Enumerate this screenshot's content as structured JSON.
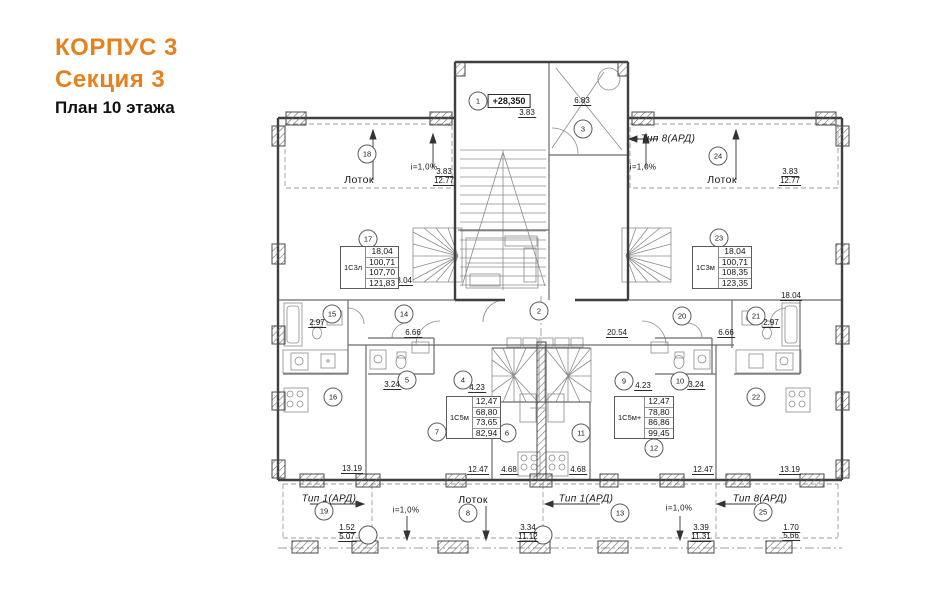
{
  "title": {
    "building": "КОРПУС 3",
    "section": "Секция 3",
    "floor": "План 10 этажа"
  },
  "colors": {
    "accent": "#e5821f",
    "wall": "#3f3f3f",
    "thin_line": "#8c8c8c"
  },
  "plan": {
    "elevation": {
      "t": "+28,350",
      "x": 509,
      "y": 101
    },
    "rooms": [
      {
        "n": "1",
        "x": 478,
        "y": 101
      },
      {
        "n": "2",
        "x": 539,
        "y": 311
      },
      {
        "n": "3",
        "x": 583,
        "y": 129
      },
      {
        "n": "4",
        "x": 463,
        "y": 380
      },
      {
        "n": "5",
        "x": 407,
        "y": 380
      },
      {
        "n": "6",
        "x": 507,
        "y": 433
      },
      {
        "n": "7",
        "x": 437,
        "y": 432
      },
      {
        "n": "8",
        "x": 468,
        "y": 513
      },
      {
        "n": "9",
        "x": 624,
        "y": 381
      },
      {
        "n": "10",
        "x": 680,
        "y": 381
      },
      {
        "n": "11",
        "x": 581,
        "y": 433
      },
      {
        "n": "12",
        "x": 654,
        "y": 448
      },
      {
        "n": "13",
        "x": 620,
        "y": 513
      },
      {
        "n": "14",
        "x": 404,
        "y": 314
      },
      {
        "n": "15",
        "x": 332,
        "y": 314
      },
      {
        "n": "16",
        "x": 333,
        "y": 397
      },
      {
        "n": "17",
        "x": 368,
        "y": 239
      },
      {
        "n": "18",
        "x": 367,
        "y": 154
      },
      {
        "n": "19",
        "x": 324,
        "y": 511
      },
      {
        "n": "20",
        "x": 682,
        "y": 316
      },
      {
        "n": "21",
        "x": 756,
        "y": 316
      },
      {
        "n": "22",
        "x": 756,
        "y": 397
      },
      {
        "n": "23",
        "x": 719,
        "y": 238
      },
      {
        "n": "24",
        "x": 718,
        "y": 156
      },
      {
        "n": "25",
        "x": 763,
        "y": 512
      }
    ],
    "dims": [
      {
        "t": "3.83",
        "x": 527,
        "y": 113
      },
      {
        "t": "6.83",
        "x": 582,
        "y": 101
      },
      {
        "t": "3.83",
        "x": 444,
        "y": 172
      },
      {
        "t": "12.77",
        "x": 444,
        "y": 181
      },
      {
        "t": "3.83",
        "x": 790,
        "y": 172
      },
      {
        "t": "12.77",
        "x": 790,
        "y": 181
      },
      {
        "t": "18.04",
        "x": 402,
        "y": 281
      },
      {
        "t": "18.04",
        "x": 791,
        "y": 296
      },
      {
        "t": "2.97",
        "x": 317,
        "y": 323
      },
      {
        "t": "2.97",
        "x": 771,
        "y": 323
      },
      {
        "t": "6.66",
        "x": 413,
        "y": 333
      },
      {
        "t": "6.66",
        "x": 726,
        "y": 333
      },
      {
        "t": "20.54",
        "x": 617,
        "y": 333
      },
      {
        "t": "3.24",
        "x": 392,
        "y": 385
      },
      {
        "t": "3.24",
        "x": 696,
        "y": 385
      },
      {
        "t": "4.23",
        "x": 477,
        "y": 388
      },
      {
        "t": "4.23",
        "x": 643,
        "y": 386
      },
      {
        "t": "13.19",
        "x": 352,
        "y": 469
      },
      {
        "t": "13.19",
        "x": 790,
        "y": 470
      },
      {
        "t": "12.47",
        "x": 478,
        "y": 470
      },
      {
        "t": "12.47",
        "x": 703,
        "y": 470
      },
      {
        "t": "4.68",
        "x": 509,
        "y": 470
      },
      {
        "t": "4.68",
        "x": 578,
        "y": 470
      },
      {
        "t": "1.52",
        "x": 347,
        "y": 528
      },
      {
        "t": "5.07",
        "x": 347,
        "y": 537
      },
      {
        "t": "3.34",
        "x": 528,
        "y": 528
      },
      {
        "t": "11.12",
        "x": 528,
        "y": 537
      },
      {
        "t": "3.39",
        "x": 701,
        "y": 528
      },
      {
        "t": "11.31",
        "x": 701,
        "y": 537
      },
      {
        "t": "1.70",
        "x": 791,
        "y": 528
      },
      {
        "t": "5.66",
        "x": 791,
        "y": 536
      }
    ],
    "area_labels": [
      {
        "t": "Лоток",
        "x": 359,
        "y": 180
      },
      {
        "t": "Лоток",
        "x": 722,
        "y": 180
      },
      {
        "t": "Лоток",
        "x": 473,
        "y": 500
      }
    ],
    "type_labels": [
      {
        "t": "Тип 8(АРД)",
        "x": 668,
        "y": 139
      },
      {
        "t": "Тип 1(АРД)",
        "x": 329,
        "y": 499
      },
      {
        "t": "Тип 1(АРД)",
        "x": 586,
        "y": 499
      },
      {
        "t": "Тип 8(АРД)",
        "x": 760,
        "y": 499
      }
    ],
    "slopes": [
      {
        "t": "i=1,0%",
        "x": 424,
        "y": 167
      },
      {
        "t": "i=1,0%",
        "x": 643,
        "y": 167
      },
      {
        "t": "i=1,0%",
        "x": 406,
        "y": 510
      },
      {
        "t": "i=1,0%",
        "x": 679,
        "y": 508
      }
    ],
    "apartments": [
      {
        "type": "1С3л",
        "values": [
          "18,04",
          "100,71",
          "107,70",
          "121,83"
        ],
        "x": 340,
        "y": 246
      },
      {
        "type": "1С3м",
        "values": [
          "18,04",
          "100,71",
          "108,35",
          "123,35"
        ],
        "x": 692,
        "y": 246
      },
      {
        "type": "1С5м",
        "values": [
          "12,47",
          "68,80",
          "73,65",
          "82,94"
        ],
        "x": 446,
        "y": 396
      },
      {
        "type": "1С5м+",
        "values": [
          "12,47",
          "78,80",
          "86,86",
          "99,45"
        ],
        "x": 614,
        "y": 396
      }
    ]
  }
}
